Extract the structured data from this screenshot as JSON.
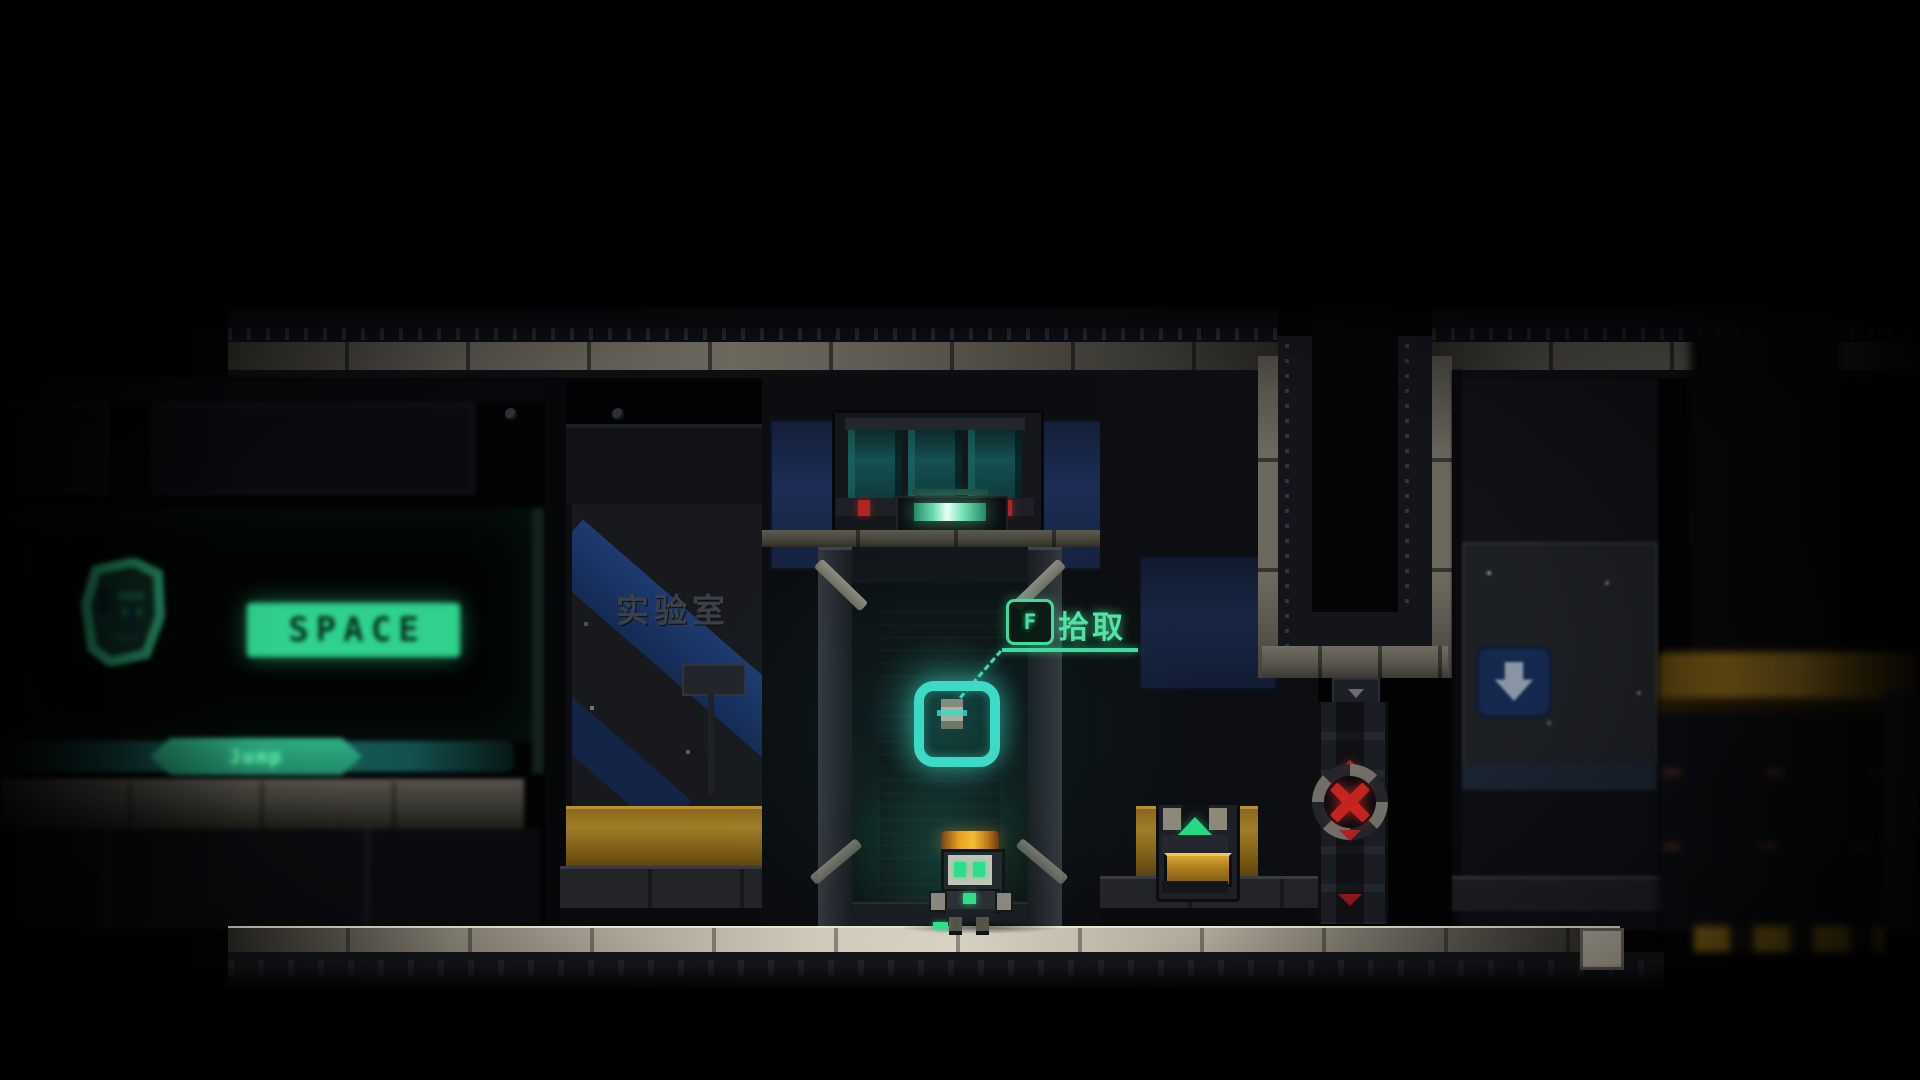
{
  "game": {
    "hud": {
      "jump_tutorial": {
        "icon": "robot-face-icon",
        "key_label": "SPACE",
        "action_label": "Jump",
        "accent_color": "#2fd18c"
      },
      "pickup_prompt": {
        "key_label": "F",
        "action_label": "拾取",
        "accent_color": "#52e8a6"
      }
    },
    "scene": {
      "lab_sign_text": "实验室",
      "entities": [
        "player-robot",
        "pickup-orb",
        "supply-chest",
        "hazard-x-pillar",
        "elevator-shaft",
        "down-arrow-sign",
        "lab-door"
      ],
      "colors": {
        "orb_cyan": "#3fe0cc",
        "hazard_red": "#c32420",
        "machine_amber": "#a07a20",
        "door_light_green": "#7ce6bc",
        "floor_light": "#d8d2c2"
      }
    }
  }
}
